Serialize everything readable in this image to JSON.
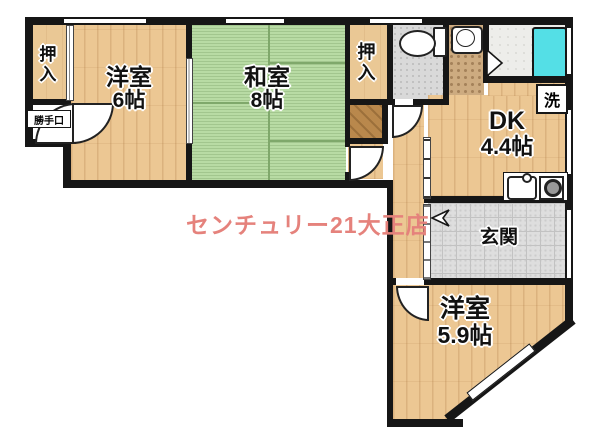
{
  "watermark": {
    "text": "センチュリー21大正店",
    "color": "#e5827c"
  },
  "rooms": {
    "closet_top_left": {
      "label": "押入"
    },
    "closet_middle": {
      "label": "押入"
    },
    "western6": {
      "name": "洋室",
      "size": "6帖"
    },
    "japanese8": {
      "name": "和室",
      "size": "8帖"
    },
    "dk": {
      "name": "DK",
      "size": "4.4帖"
    },
    "western59": {
      "name": "洋室",
      "size": "5.9帖"
    },
    "genkan": {
      "label": "玄関"
    },
    "laundry": {
      "label": "洗"
    },
    "kitchen_door": {
      "label": "勝手口"
    }
  },
  "colors": {
    "wall": "#161616",
    "wood_floor": "#ecc793",
    "tatami": "#b8dba4",
    "bathtub": "#54dfe6",
    "entry_tile": "#dedede",
    "watermark": "#e5827c"
  }
}
